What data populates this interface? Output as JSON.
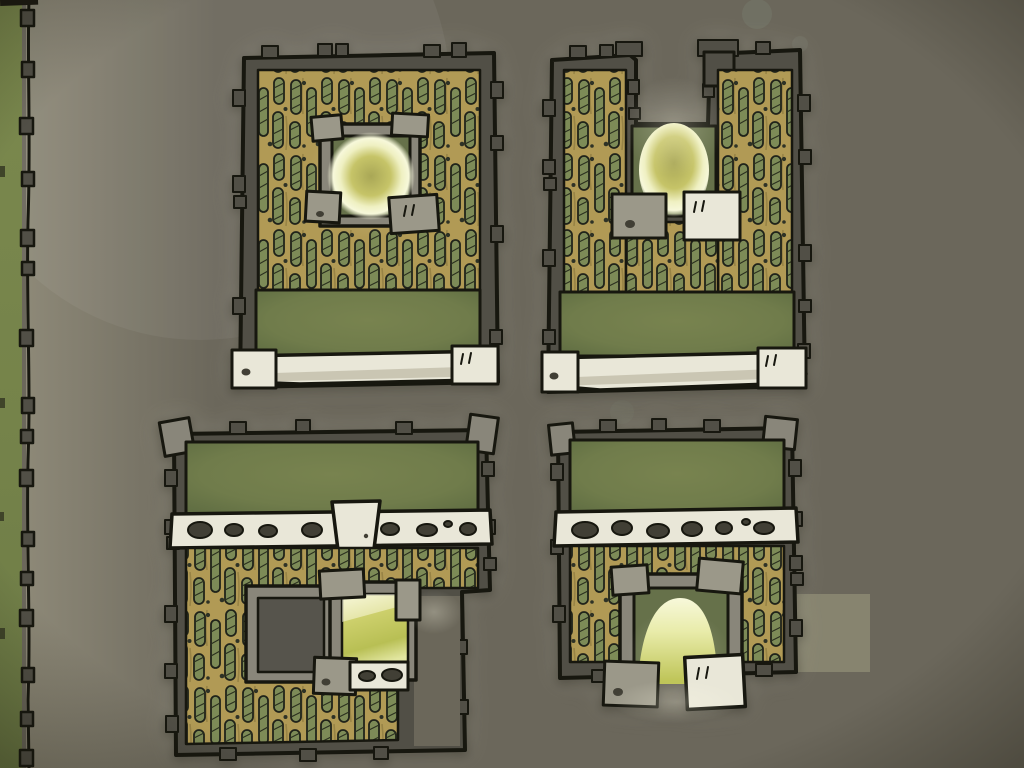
{
  "scene": {
    "description": "Hand-inked top-down game map: four walled thatched-roof compounds, each with a glowing light chamber, a palisade boundary wall on the left edge, and a pale placement-highlight square beside the bottom-right compound."
  },
  "map": {
    "boundary": "palisade wall with block posts along left edge over a green verge",
    "structures": [
      {
        "name": "top-left-compound",
        "light": "round glow in central stone chamber"
      },
      {
        "name": "top-right-compound",
        "light": "oval glow in north recess chamber"
      },
      {
        "name": "bottom-left-compound",
        "light": "lit doorway room beside dark room in courtyard"
      },
      {
        "name": "bottom-right-compound",
        "light": "domed glow in south doorway"
      }
    ],
    "highlight": "pale square marker on ground right of bottom-right compound"
  },
  "colors": {
    "ground": "#6b675b",
    "ground_light": "#8d897b",
    "ink": "#17170f",
    "wall": "#514f46",
    "stone": "#9b9889",
    "stone_frame": "#89867a",
    "stone_light": "#e9e7d8",
    "stone_shadow": "#c6c2af",
    "hole_dark": "#413f35",
    "thatch_base": "#b19a55",
    "thatch_slot": "#7d8b57",
    "thatch_streak": "#8f7b40",
    "thatch_dot": "#2e3226",
    "roof_light": "#78834f",
    "roof": "#707c4b",
    "roof_dark": "#5d6b41",
    "court_green": "#66714a",
    "room_dark": "#56544c",
    "corridor": "#6b675a",
    "glow_core": "#a9a756",
    "glow_mid": "#c6c468",
    "glow_rim": "#eff0c2",
    "glow_bright": "#f7f8da",
    "strip_green": "#7b894e",
    "strip_green_dark": "#6d7b46",
    "highlight": "#87846f",
    "bokeh": "#8fa492"
  }
}
